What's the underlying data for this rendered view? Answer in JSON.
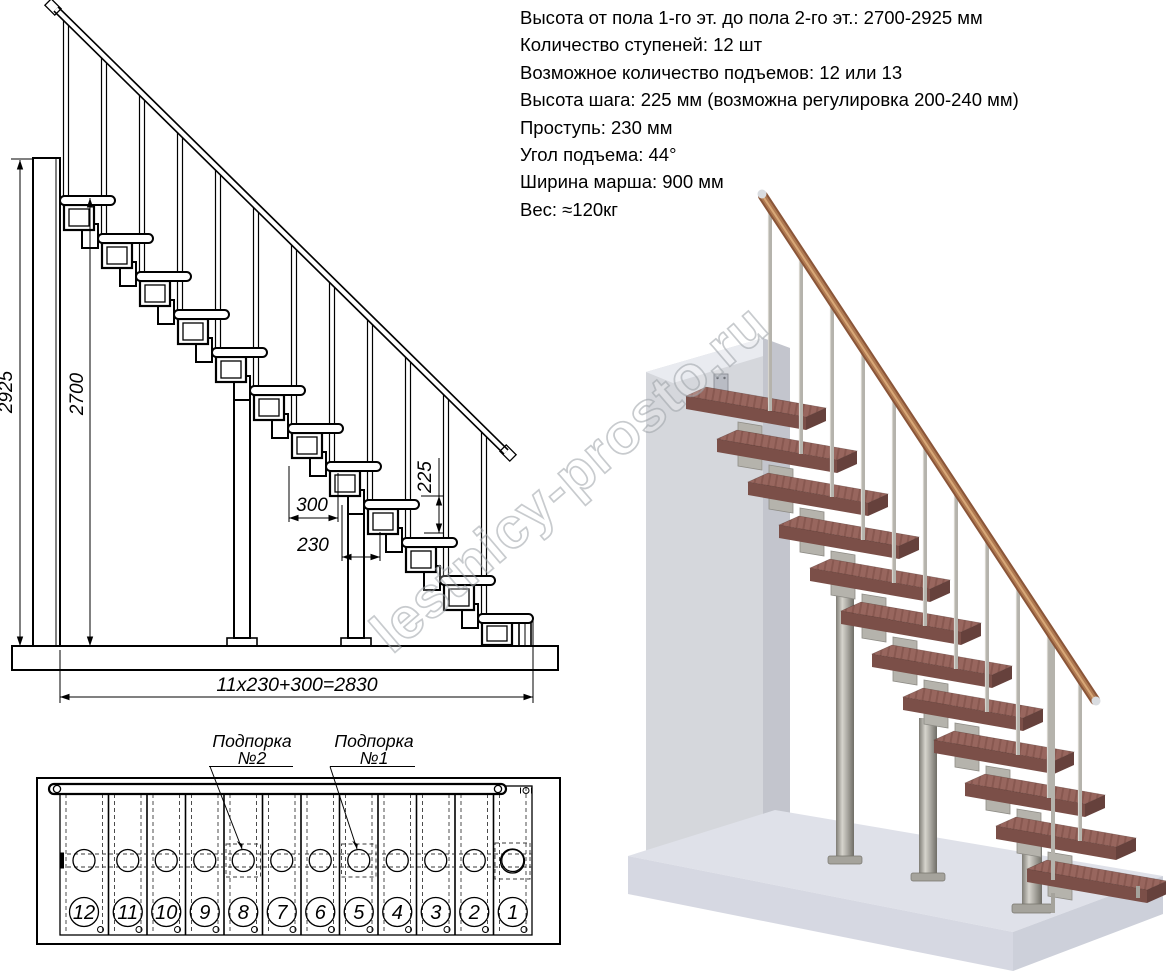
{
  "specs": {
    "lines": [
      "Высота от пола 1-го эт. до пола 2-го эт.: 2700-2925 мм",
      "Количество ступеней: 12 шт",
      "Возможное количество подъемов: 12 или 13",
      "Высота шага: 225 мм (возможна регулировка 200-240 мм)",
      "Проступь: 230 мм",
      "Угол подъема: 44°",
      "Ширина марша: 900 мм",
      "Вес: ≈120кг"
    ]
  },
  "elevation": {
    "dims": {
      "total_height": "2925",
      "stair_height": "2700",
      "top_run": "300",
      "tread_run": "230",
      "rise": "225",
      "total_run": "11x230+300=2830"
    }
  },
  "plan": {
    "step_numbers": [
      "12",
      "11",
      "10",
      "9",
      "8",
      "7",
      "6",
      "5",
      "4",
      "3",
      "2",
      "1"
    ],
    "callouts": [
      {
        "title": "Подпорка",
        "num": "№2"
      },
      {
        "title": "Подпорка",
        "num": "№1"
      }
    ]
  },
  "watermark": {
    "text": "lestnicy-prosto.ru"
  },
  "colors": {
    "line": "#000000",
    "tread_top": "#98665e",
    "tread_front": "#7b4f48",
    "tread_side": "#66413c",
    "rail_dark": "#8a5538",
    "rail_mid": "#b07a52",
    "rail_light": "#d8a878",
    "metal": "#b5b3ac",
    "metal_light": "#d6d4cd",
    "metal_dark": "#6f6d66",
    "wall_front": "#d5d7dc",
    "wall_top": "#e9ebf0",
    "wall_side": "#c3c5cd",
    "floor_top": "#dfe1e9",
    "floor_front": "#cdd0da",
    "floor_side": "#d6d8e2",
    "watermark": "#9aa0a6"
  }
}
